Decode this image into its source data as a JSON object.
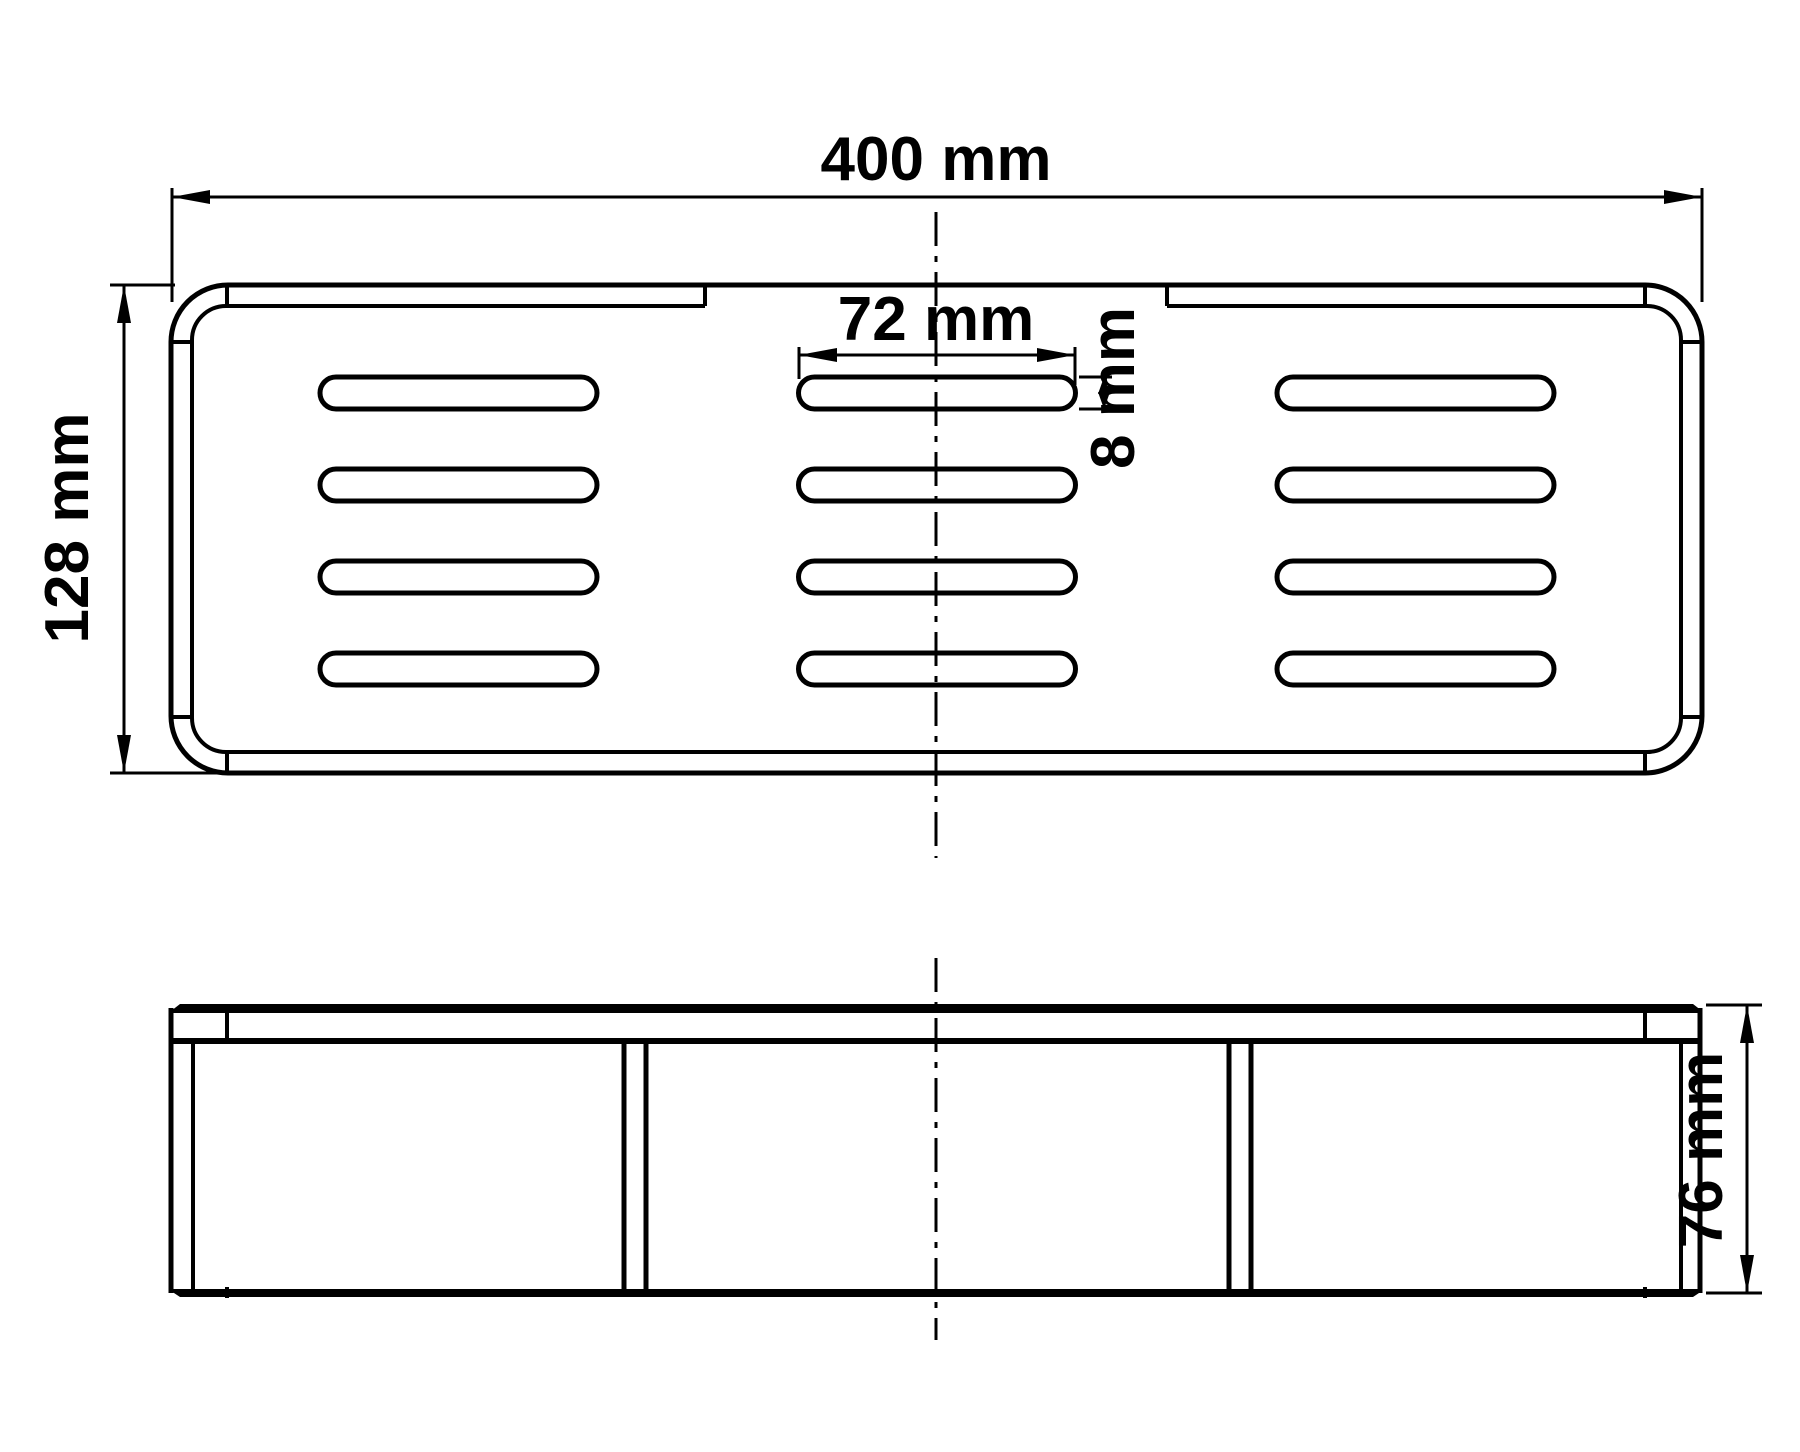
{
  "drawing": {
    "background_color": "#ffffff",
    "line_color": "#000000",
    "dimensions": {
      "overall_width": {
        "value": 400,
        "unit": "mm",
        "label": "400 mm"
      },
      "overall_depth": {
        "value": 128,
        "unit": "mm",
        "label": "128 mm"
      },
      "slot_length": {
        "value": 72,
        "unit": "mm",
        "label": "72 mm"
      },
      "slot_height": {
        "value": 8,
        "unit": "mm",
        "label": "8 mm"
      },
      "overall_height": {
        "value": 76,
        "unit": "mm",
        "label": "76 mm"
      }
    },
    "slot_grid": {
      "columns": 3,
      "rows": 4,
      "col_x": [
        320,
        798.5,
        1277
      ],
      "row_y": [
        377,
        469,
        561,
        653
      ],
      "slot_w": 277,
      "slot_h": 32,
      "slot_r": 16
    }
  }
}
